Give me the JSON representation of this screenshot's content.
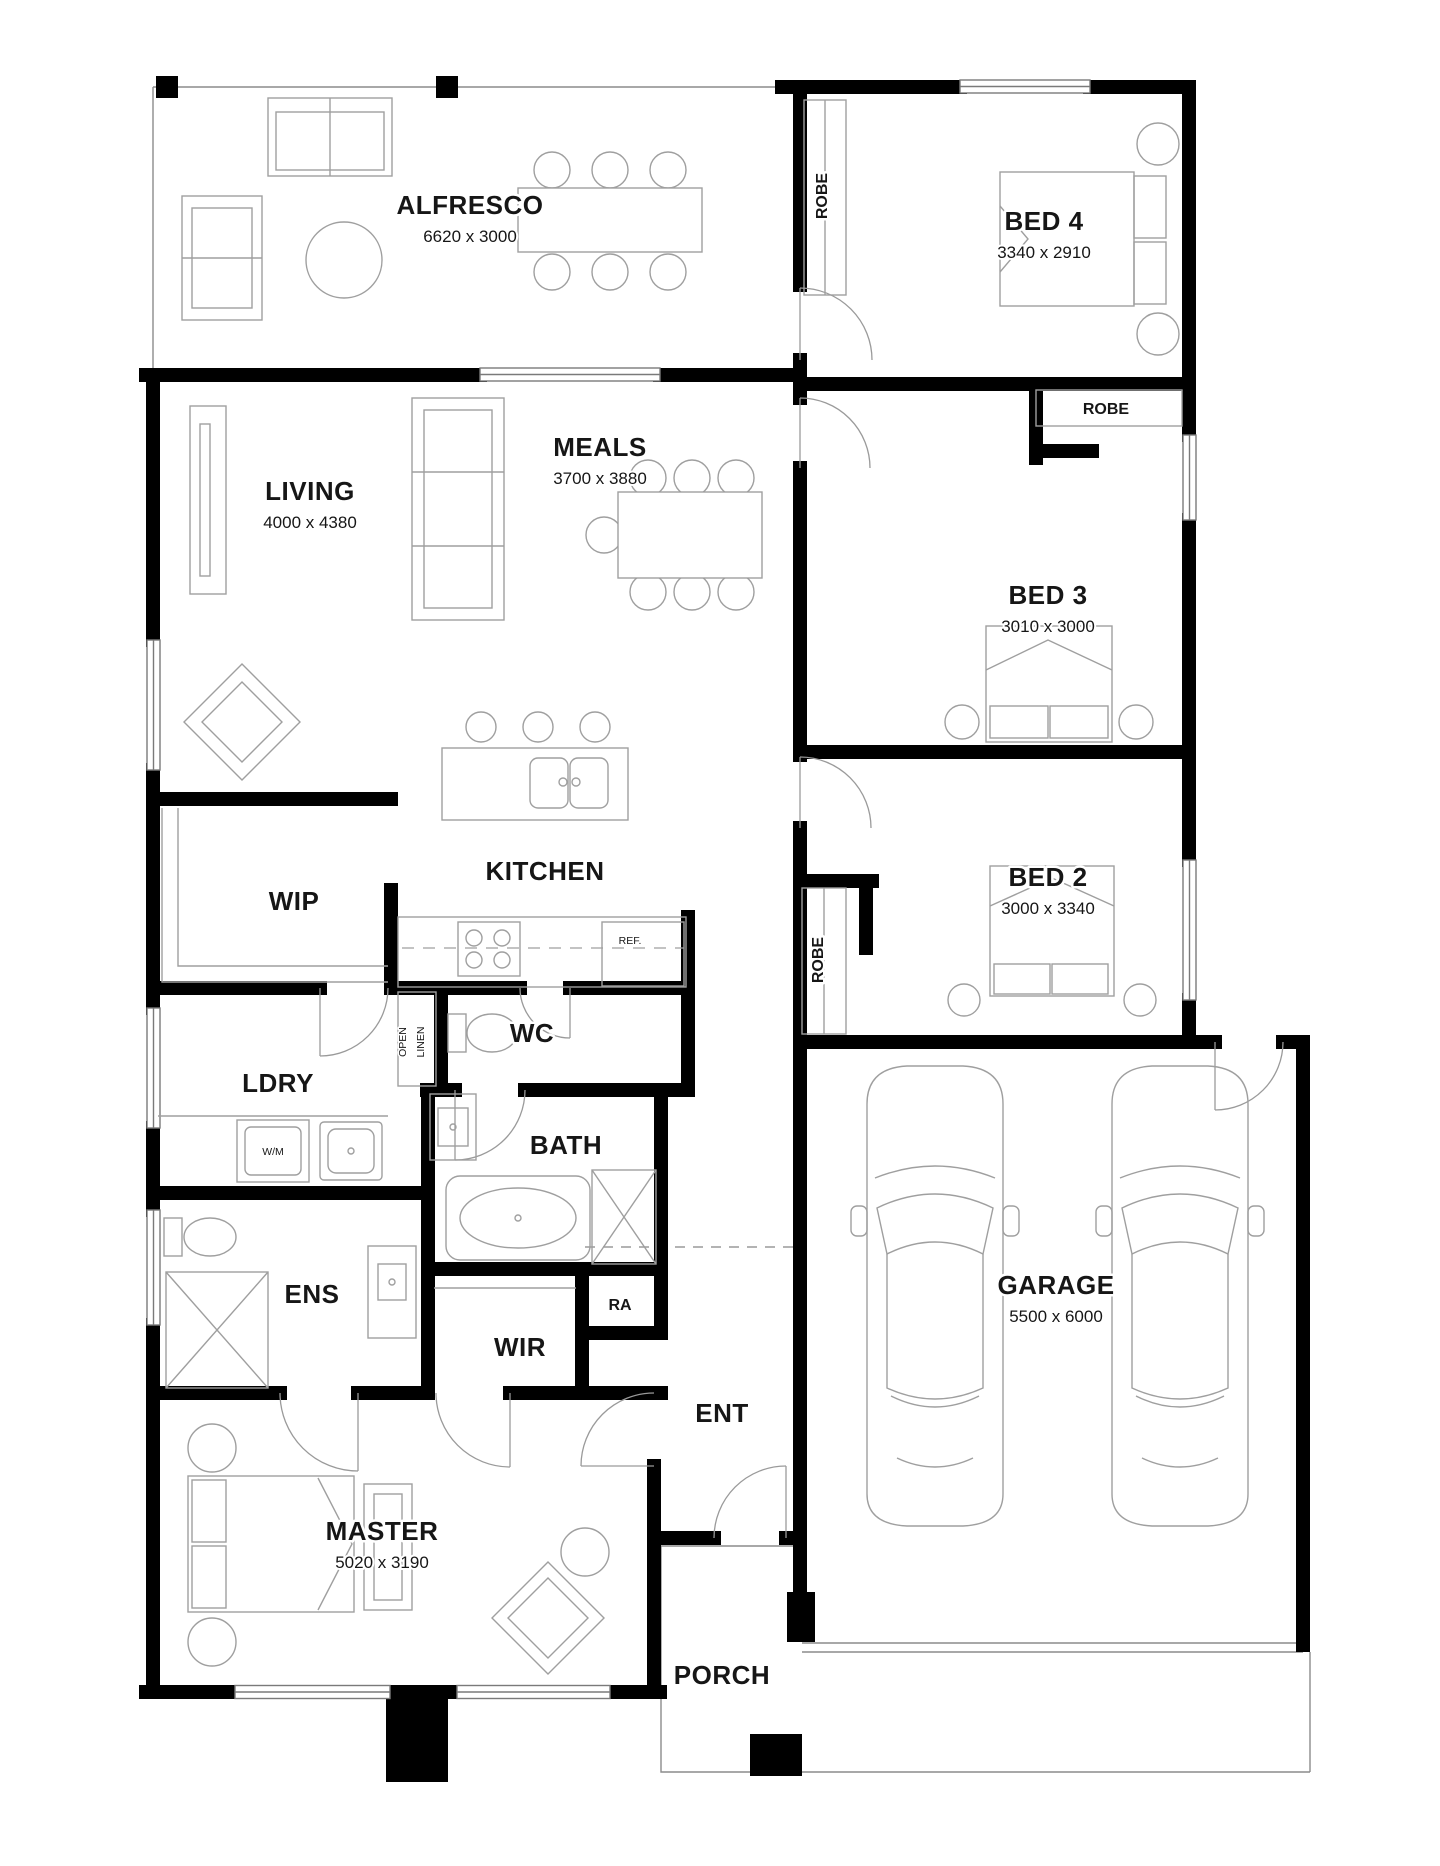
{
  "plan_title": "Floor plan",
  "colors": {
    "wall": "#000000",
    "thin_line": "#8c8c8c",
    "furniture": "#9f9f9f",
    "text": "#161616",
    "background": "#ffffff"
  },
  "rooms": {
    "alfresco": {
      "name": "ALFRESCO",
      "dims": "6620 x 3000"
    },
    "bed4": {
      "name": "BED 4",
      "dims": "3340 x 2910"
    },
    "living": {
      "name": "LIVING",
      "dims": "4000 x 4380"
    },
    "meals": {
      "name": "MEALS",
      "dims": "3700 x 3880"
    },
    "bed3": {
      "name": "BED 3",
      "dims": "3010 x 3000"
    },
    "kitchen": {
      "name": "KITCHEN"
    },
    "wip": {
      "name": "WIP"
    },
    "bed2": {
      "name": "BED 2",
      "dims": "3000 x 3340"
    },
    "ldry": {
      "name": "LDRY"
    },
    "wc": {
      "name": "WC"
    },
    "bath": {
      "name": "BATH"
    },
    "ens": {
      "name": "ENS"
    },
    "wir": {
      "name": "WIR"
    },
    "ra": {
      "name": "RA"
    },
    "ent": {
      "name": "ENT"
    },
    "master": {
      "name": "MASTER",
      "dims": "5020 x 3190"
    },
    "garage": {
      "name": "GARAGE",
      "dims": "5500 x 6000"
    },
    "porch": {
      "name": "PORCH"
    }
  },
  "fixtures": {
    "robe": "ROBE",
    "open_linen_word1": "OPEN",
    "open_linen_word2": "LINEN",
    "fridge": "REF.",
    "washing_machine": "W/M"
  }
}
